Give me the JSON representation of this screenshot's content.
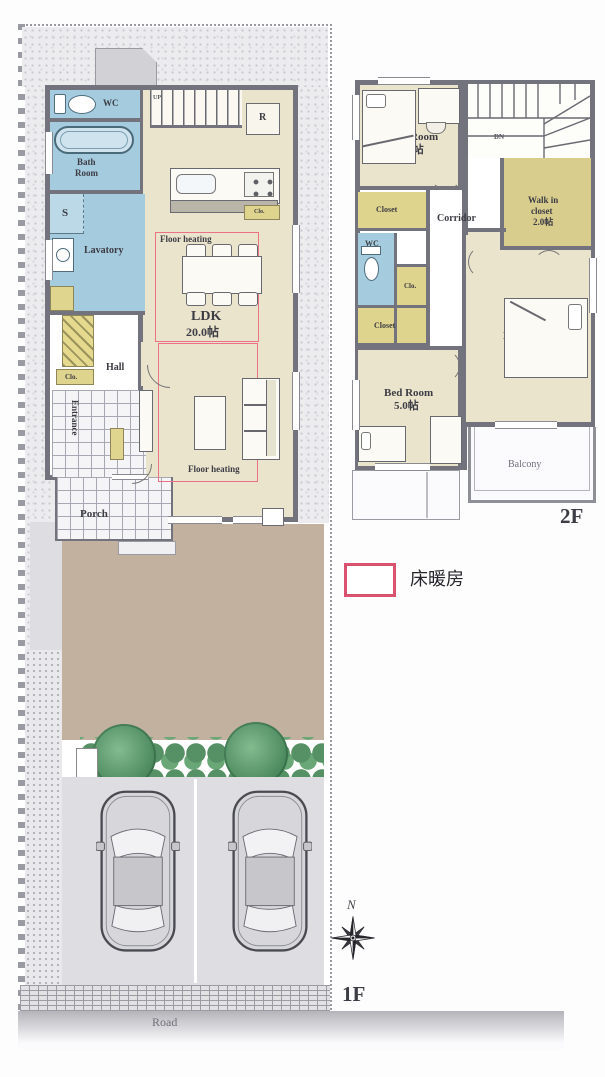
{
  "floor1": {
    "floor_label": "1F",
    "road_label": "Road",
    "stairs_label": "UP",
    "rooms": {
      "wc": "WC",
      "bath_line1": "Bath",
      "bath_line2": "Room",
      "storage_s": "S",
      "lavatory": "Lavatory",
      "closet_abbr": "Clo.",
      "hall": "Hall",
      "entrance": "Entrance",
      "porch": "Porch",
      "ldk": "LDK",
      "ldk_size": "20.0帖",
      "refrigerator": "R",
      "kitchen_closet_abbr": "Clo.",
      "floor_heating_upper": "Floor heating",
      "floor_heating_lower": "Floor heating"
    }
  },
  "floor2": {
    "floor_label": "2F",
    "stairs_label": "DN",
    "rooms": {
      "bedroom1": "Bed Room",
      "bedroom1_size": "4.5帖",
      "walkin_line1": "Walk in",
      "walkin_line2": "closet",
      "walkin_size": "2.0帖",
      "corridor": "Corridor",
      "closet_upper": "Closet",
      "wc": "WC",
      "closet_abbr": "Clo.",
      "closet_lower": "Closet",
      "bedroom2": "Bed Room",
      "bedroom2_size": "5.0帖",
      "master_line1": "Master",
      "master_line2": "Bed Room",
      "master_size": "7.0帖",
      "balcony": "Balcony"
    }
  },
  "legend": {
    "floor_heating": "床暖房"
  },
  "compass": {
    "north": "N"
  },
  "colors": {
    "wall": "#73737d",
    "room_beige": "#ebe4cd",
    "wet_blue": "#a5cbdf",
    "closet_yellow": "#dfd48d",
    "floor_heating_pink": "#ea7186",
    "garden_tan": "#c3b1a0",
    "tree_green": "#4c8a5e"
  }
}
